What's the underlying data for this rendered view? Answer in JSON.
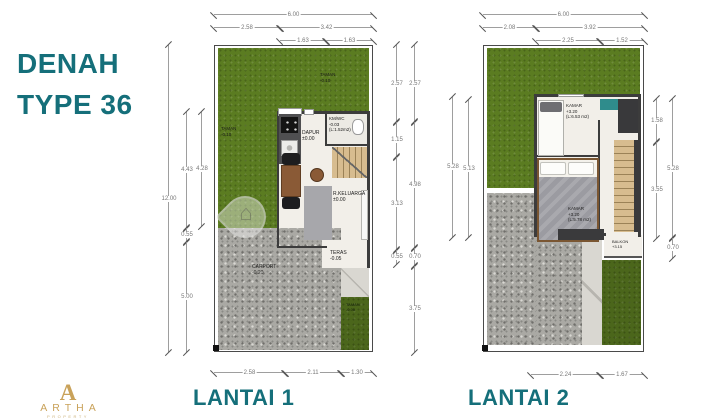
{
  "title": {
    "line1": "DENAH",
    "line2": "TYPE 36"
  },
  "colors": {
    "accent": "#156f7a",
    "grass": "#5b7c21",
    "paving": "#aaa9a4",
    "gold": "#c9a25a"
  },
  "logo": {
    "monogram": "A",
    "name": "ARTHA",
    "subtitle": "PROPERTY"
  },
  "plan1": {
    "title": "LANTAI 1",
    "labels": {
      "taman_top": {
        "name": "TAMAN",
        "level": "-0.10"
      },
      "taman_left": {
        "name": "TAMAN",
        "level": "-0.10"
      },
      "dapur": {
        "name": "DAPUR",
        "level": "±0.00"
      },
      "kmwc": {
        "name": "KM/WC",
        "level": "-0.03",
        "area": "(L:1.52m2)"
      },
      "keluarga": {
        "name": "R.KELUARGA",
        "level": "±0.00"
      },
      "teras": {
        "name": "TERAS",
        "level": "-0.05"
      },
      "carport": {
        "name": "CARPORT",
        "level": "-0.20"
      },
      "taman_belakang": {
        "name": "TAMAN",
        "level": "-0.05"
      }
    },
    "dims": {
      "top": [
        "6.00",
        "2.58",
        "3.42",
        "1.63",
        "1.63"
      ],
      "left": [
        "12.00",
        "4.43",
        "0.55",
        "5.00",
        "4.28"
      ],
      "right": [
        "2.57",
        "1.15",
        "3.13",
        "0.55",
        "2.57",
        "4.98",
        "0.70",
        "3.75"
      ],
      "bottom": [
        "2.58",
        "2.11",
        "1.30"
      ]
    }
  },
  "plan2": {
    "title": "LANTAI 2",
    "labels": {
      "kamar1": {
        "name": "KAMAR",
        "level": "+3.20",
        "area": "(L:6.53 m2)"
      },
      "kamar2": {
        "name": "KAMAR",
        "level": "+3.20",
        "area": "(L:5.78 m2)"
      },
      "balkon": {
        "name": "BALKON",
        "level": "+3.15"
      }
    },
    "dims": {
      "top": [
        "6.00",
        "2.08",
        "3.92",
        "2.25",
        "1.52"
      ],
      "left": [
        "5.28",
        "5.13"
      ],
      "right": [
        "1.58",
        "3.55",
        "5.28",
        "0.70"
      ],
      "bottom": [
        "2.24",
        "1.67"
      ]
    }
  }
}
